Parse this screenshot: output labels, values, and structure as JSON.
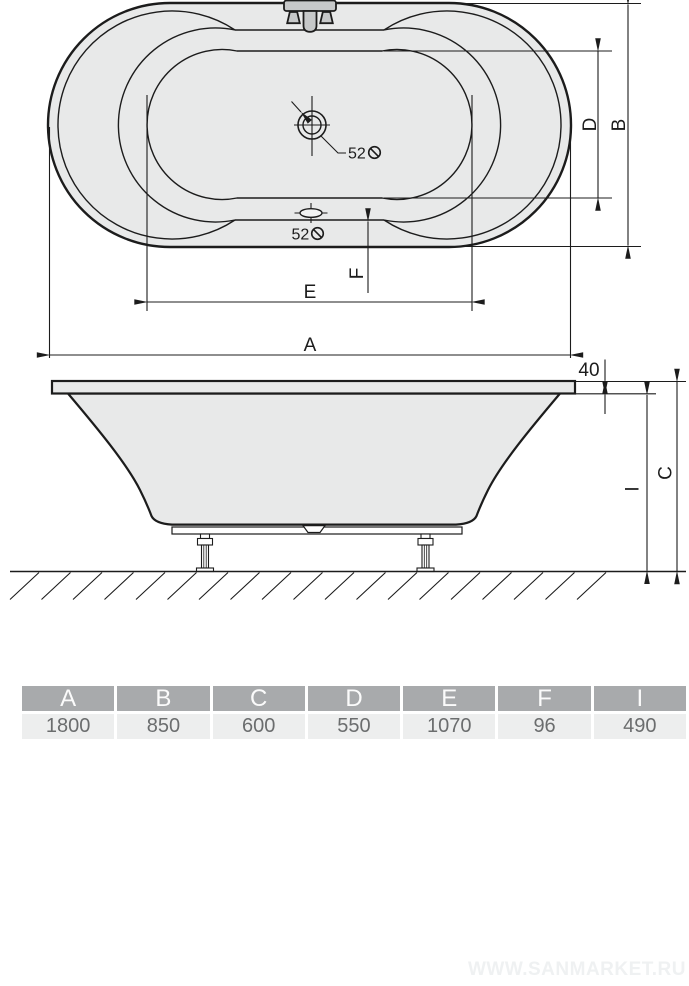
{
  "drawing": {
    "dims": {
      "a": "A",
      "b": "B",
      "c": "C",
      "d": "D",
      "e": "E",
      "f": "F",
      "i": "I"
    },
    "top_view": {
      "drain_diameter": "52",
      "overflow_diameter": "52"
    },
    "side_view": {
      "rim_height": "40"
    },
    "icons": {
      "diameter_symbol": "circle-with-backslash"
    }
  },
  "table": {
    "headers": [
      "A",
      "B",
      "C",
      "D",
      "E",
      "F",
      "I"
    ],
    "values": [
      "1800",
      "850",
      "600",
      "550",
      "1070",
      "96",
      "490"
    ]
  },
  "watermark": "WWW.SANMARKET.RU",
  "colors": {
    "fill": "#e8e9e9",
    "line": "#1c1c1c",
    "faucet": "#c6c8c9",
    "header_bg": "#a8aaac",
    "header_text": "#fbfbfb",
    "cell_bg": "#edeeee",
    "cell_text": "#6b6d6e",
    "watermark": "#eff1f2"
  }
}
